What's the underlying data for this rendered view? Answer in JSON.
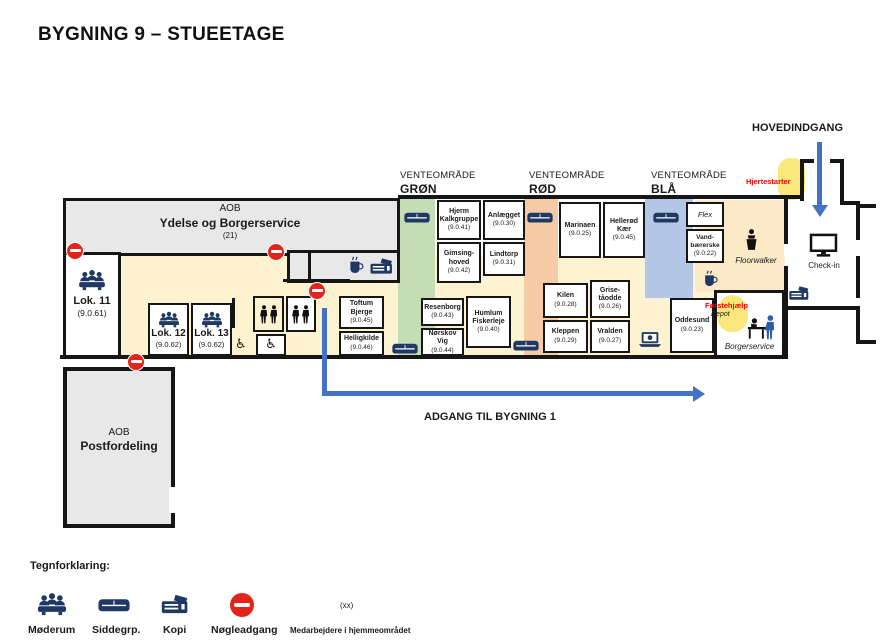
{
  "title": "BYGNING 9 – STUEETAGE",
  "plan": {
    "aob_ydelse": {
      "org": "AOB",
      "name": "Ydelse og Borgerservice",
      "count": "(21)"
    },
    "aob_post": {
      "org": "AOB",
      "name": "Postfordeling"
    },
    "waiting_areas": [
      {
        "id": "gron",
        "label": "VENTEOMRÅDE",
        "name": "GRØN"
      },
      {
        "id": "rod",
        "label": "VENTEOMRÅDE",
        "name": "RØD"
      },
      {
        "id": "blaa",
        "label": "VENTEOMRÅDE",
        "name": "BLÅ"
      }
    ],
    "rooms": [
      {
        "name": "Lok. 11",
        "code": "(9.0.61)"
      },
      {
        "name": "Lok. 12",
        "code": "(9.0.62)"
      },
      {
        "name": "Lok. 13",
        "code": "(9.0.62)"
      },
      {
        "name": "Hjerm Kalkgruppe",
        "code": "(9.0.41)"
      },
      {
        "name": "Anlægget",
        "code": "(9.0.30)"
      },
      {
        "name": "Gimsing-hoved",
        "code": "(9.0.42)"
      },
      {
        "name": "Lindtorp",
        "code": "(9.0.31)"
      },
      {
        "name": "Toftum Bjerge",
        "code": "(9.0.45)"
      },
      {
        "name": "Helligkilde",
        "code": "(9.0.46)"
      },
      {
        "name": "Resenborg",
        "code": "(9.0.43)"
      },
      {
        "name": "Nørskov Vig",
        "code": "(9.0.44)"
      },
      {
        "name": "Humlum Fiskerleje",
        "code": "(9.0.40)"
      },
      {
        "name": "Marinaen",
        "code": "(9.0.25)"
      },
      {
        "name": "Hellerød Kær",
        "code": "(9.0.45)"
      },
      {
        "name": "Kilen",
        "code": "(9.0.28)"
      },
      {
        "name": "Grise-tåodde",
        "code": "(9.0.26)"
      },
      {
        "name": "Kleppen",
        "code": "(9.0.29)"
      },
      {
        "name": "Vralden",
        "code": "(9.0.27)"
      },
      {
        "name": "Flex",
        "code": ""
      },
      {
        "name": "Vand-bærerske",
        "code": "(9.0.22)"
      },
      {
        "name": "Oddesund",
        "code": "(9.0.23)"
      }
    ],
    "labels": {
      "hovedindgang": "HOVEDINDGANG",
      "hjertestarter": "Hjertestarter",
      "checkin": "Check-in",
      "floorwalker": "Floorwalker",
      "forstehjaelp": "Førstehjælp",
      "depot": "Depot",
      "borgerservice": "Borgerservice",
      "adgang": "ADGANG TIL BYGNING 1"
    }
  },
  "legend": {
    "heading": "Tegnforklaring:",
    "items": [
      {
        "icon": "meeting-icon",
        "label": "Møderum"
      },
      {
        "icon": "sofa-icon",
        "label": "Siddegrp."
      },
      {
        "icon": "copier-icon",
        "label": "Kopi"
      },
      {
        "icon": "no-entry-icon",
        "label": "Nøgleadgang"
      }
    ],
    "staff_symbol": "(xx)",
    "staff_label": "Medarbejdere i hjemmeområdet"
  },
  "colors": {
    "navy": "#1f3864",
    "green_area": "#c5ddb4",
    "red_area": "#f5cba6",
    "blue_area": "#b4c7e7",
    "corridor": "#fdf3d1",
    "tan_area": "#fbe9c7",
    "yellow_marker": "#fbe87d",
    "no_entry_red": "#e1251b",
    "arrow_blue": "#4472c4",
    "alert_text_red": "#fe0000"
  }
}
